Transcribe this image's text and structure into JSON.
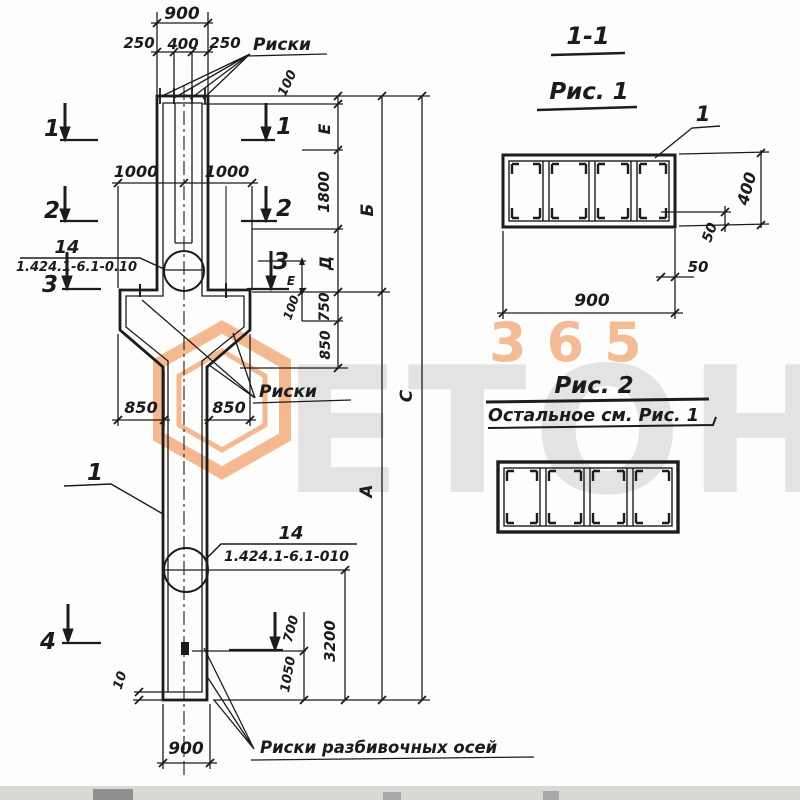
{
  "titles": {
    "section_cut": "1-1",
    "fig1": "Рис. 1",
    "fig2": "Рис. 2",
    "fig2_note": "Остальное см. Рис. 1"
  },
  "labels": {
    "riski_top": "Риски",
    "riski_console": "Риски",
    "riski_axes": "Риски разбивочных осей",
    "position_1": "1",
    "fig1_bar": "1"
  },
  "callout_top": {
    "item": "14",
    "series": "1.424.1-6.1-0.10"
  },
  "callout_bottom": {
    "item": "14",
    "series": "1.424.1-6.1-010"
  },
  "markers": {
    "m1": "1",
    "m2": "2",
    "m3": "3",
    "m4": "4"
  },
  "dims": {
    "top_overall": "900",
    "top_left": "250",
    "top_mid": "400",
    "top_right": "250",
    "console_left": "1000",
    "console_right": "1000",
    "corbel_left": "850",
    "corbel_right": "850",
    "right_100": "100",
    "right_e": "Е",
    "right_1800": "1800",
    "right_d": "Д",
    "right_750": "750",
    "right_850": "850",
    "right_b": "Б",
    "right_a": "А",
    "right_c": "С",
    "mark_e": "Е",
    "mark_100": "100",
    "bottom_700": "700",
    "bottom_1050": "1050",
    "bottom_3200": "3200",
    "bottom_10": "10",
    "bottom_overall": "900",
    "fig1_height": "400",
    "fig1_cover_v": "50",
    "fig1_cover_h": "50",
    "fig1_width": "900"
  },
  "watermark": {
    "number": "365",
    "word": "ЕТОН",
    "number_color": "#f4b58c",
    "logo_color": "#f1a774",
    "word_color": "#e3e3e3"
  }
}
